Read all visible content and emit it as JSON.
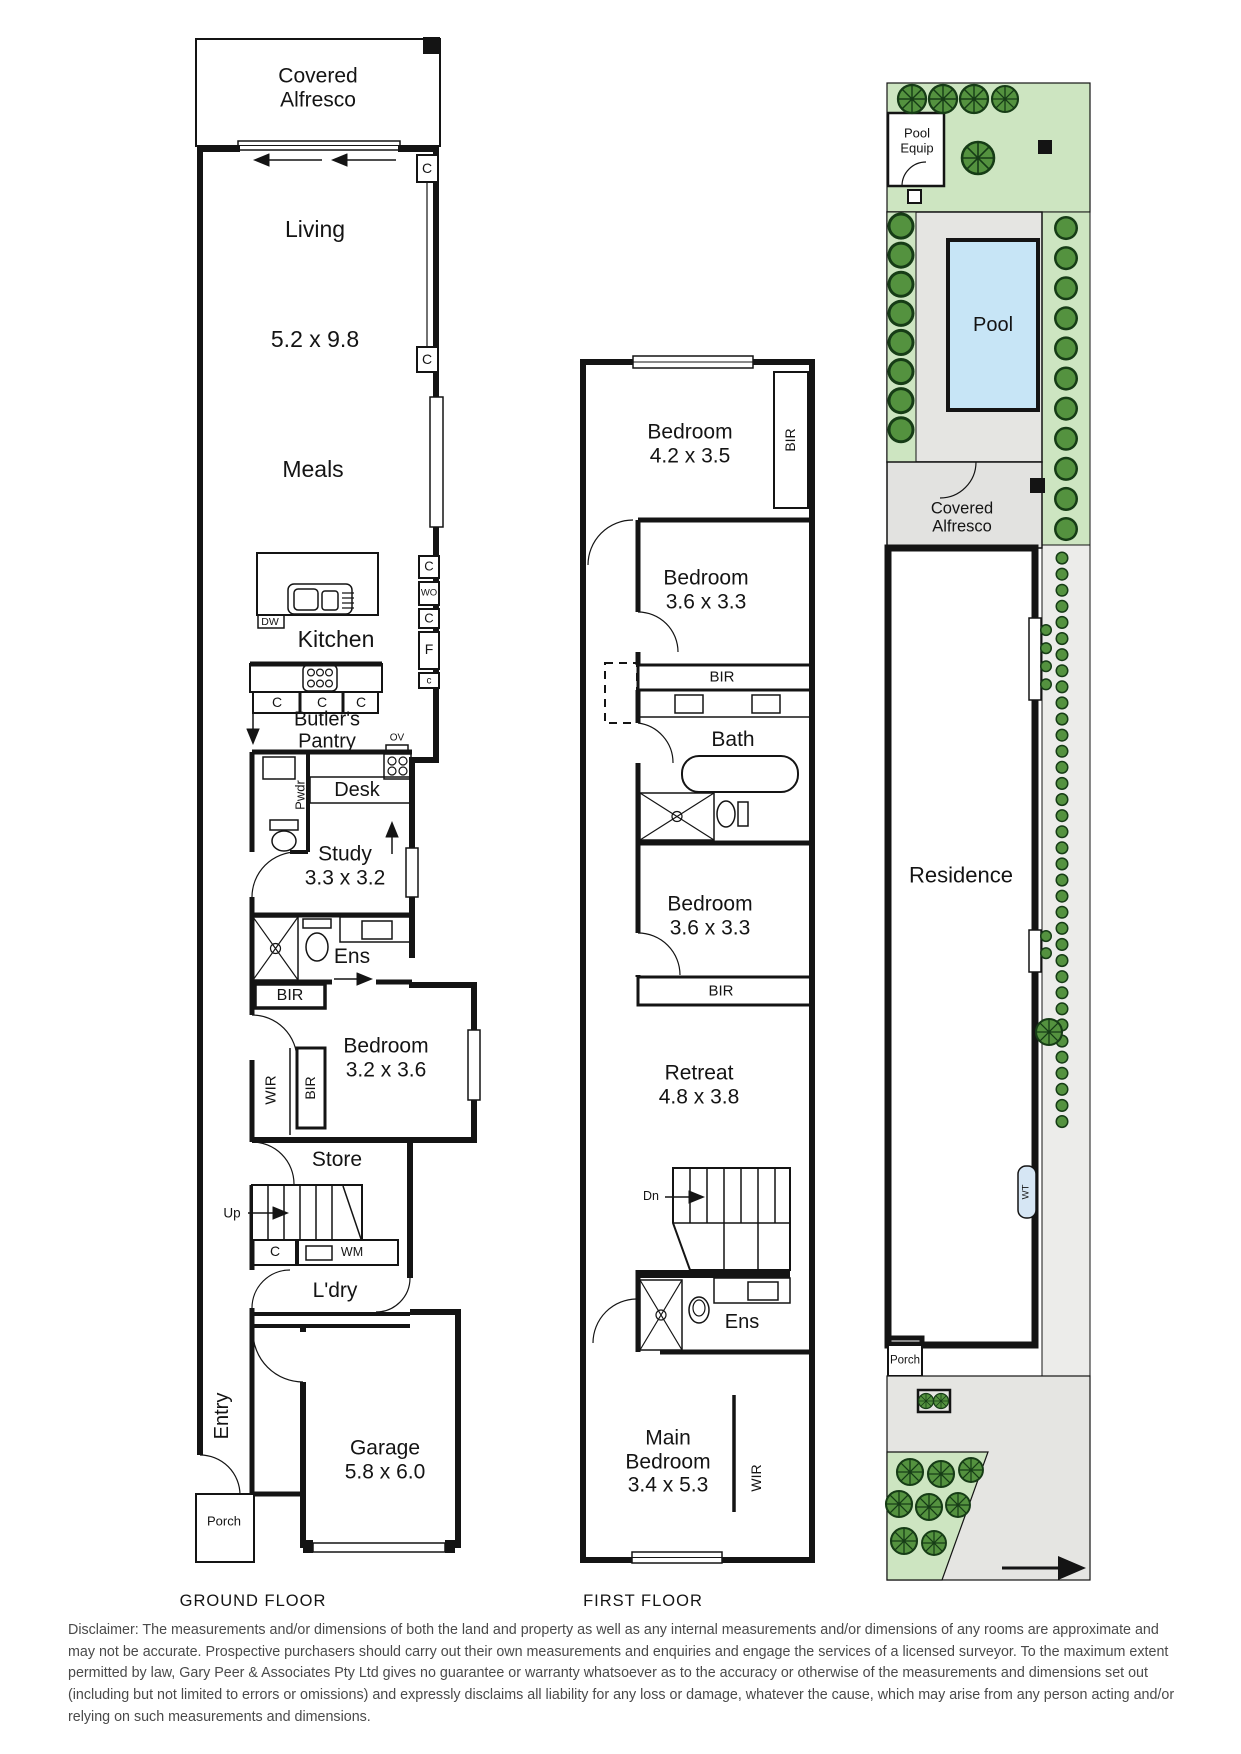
{
  "ground": {
    "covered_alfresco": "Covered\nAlfresco",
    "living": "Living",
    "living_dim": "5.2 x 9.8",
    "meals": "Meals",
    "kitchen": "Kitchen",
    "dw": "DW",
    "c_top1": "C",
    "c_top2": "C",
    "c_right1": "C",
    "wo": "WO",
    "c_right2": "C",
    "f": "F",
    "c_small": "c",
    "bench_c1": "C",
    "bench_c2": "C",
    "bench_c3": "C",
    "butlers_pantry": "Butler's\nPantry",
    "ov": "OV",
    "pwdr": "Pwdr",
    "desk": "Desk",
    "study": "Study\n3.3 x 3.2",
    "ens": "Ens",
    "bir": "BIR",
    "bedroom": "Bedroom\n3.2 x 3.6",
    "wir": "WIR",
    "bir_vert": "BIR",
    "store": "Store",
    "up": "Up",
    "c_stair": "C",
    "wm": "WM",
    "ldry": "L'dry",
    "entry": "Entry",
    "garage": "Garage\n5.8 x 6.0",
    "porch": "Porch",
    "caption": "GROUND FLOOR"
  },
  "first": {
    "bedroom1": "Bedroom\n4.2 x 3.5",
    "bir1": "BIR",
    "bedroom2": "Bedroom\n3.6 x 3.3",
    "bir2": "BIR",
    "bath": "Bath",
    "bedroom3": "Bedroom\n3.6 x 3.3",
    "bir3": "BIR",
    "retreat": "Retreat\n4.8 x 3.8",
    "dn": "Dn",
    "ens": "Ens",
    "main_bedroom": "Main\nBedroom\n3.4 x 5.3",
    "wir": "WIR",
    "caption": "FIRST FLOOR"
  },
  "site": {
    "pool_equip": "Pool\nEquip",
    "pool": "Pool",
    "covered_alfresco": "Covered\nAlfresco",
    "residence": "Residence",
    "wt": "WT",
    "porch": "Porch"
  },
  "colors": {
    "wall": "#141414",
    "garden_green": "#cde5c1",
    "tree_green": "#54923f",
    "paving_gray": "#e5e5e2",
    "pool_blue": "#c7e5f6"
  },
  "disclaimer": "Disclaimer: The measurements and/or dimensions of both the land and property as well as any internal measurements and/or dimensions of any rooms are approximate and may not be accurate. Prospective purchasers should carry out their own measurements and enquiries and engage the services of a licensed surveyor. To the maximum extent permitted by law, Gary Peer & Associates Pty Ltd gives no guarantee or warranty whatsoever as to the accuracy or otherwise of the measurements and dimensions set out (including but not limited to errors or omissions) and expressly disclaims all liability for any loss or damage, whatever the cause, which may arise from any person acting and/or relying on such measurements and dimensions."
}
